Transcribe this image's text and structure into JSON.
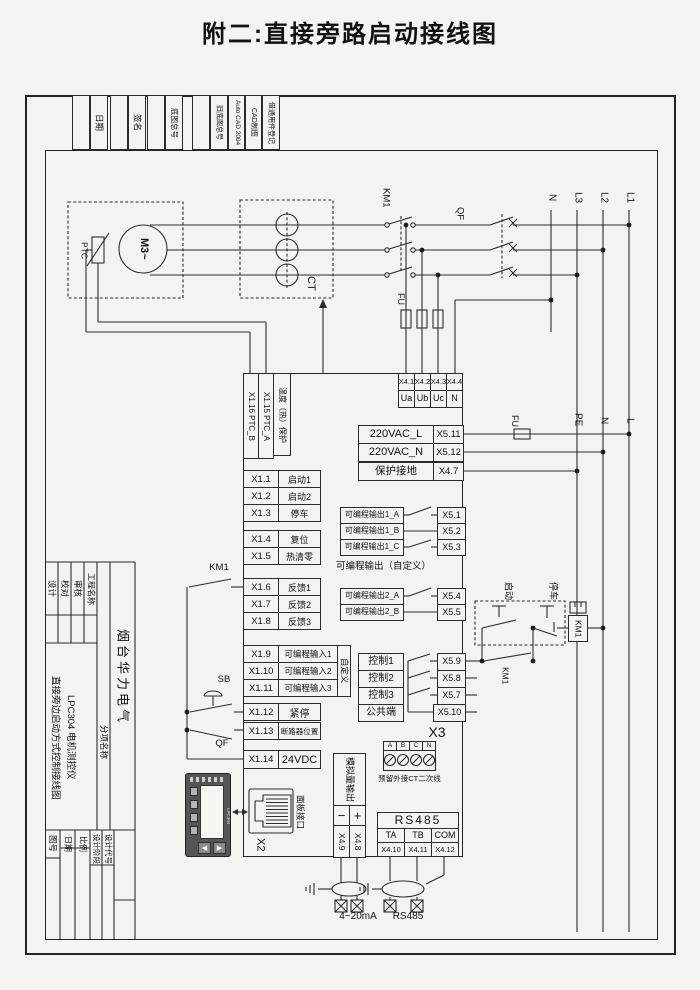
{
  "page_title": "附二:直接旁路启动接线图",
  "header_strip": {
    "date": "日期",
    "sign": "签名",
    "base_no": "底图总号",
    "old_base_no": "旧底图总号",
    "cad": "Auto CAD 2004",
    "cad2": "CAD制图",
    "borrow": "借通用件登记"
  },
  "title_block": {
    "design": "设计",
    "check": "校对",
    "review": "审核",
    "proj": "工程名称",
    "company": "烟台华力电气",
    "product": "LPC304 电机测控仪",
    "dtitle": "直接旁边启动方式控制接线图",
    "sub": "分项名称",
    "dno": "图号",
    "date": "日期",
    "scale": "比例",
    "stage": "设计阶段",
    "code": "设计代号"
  },
  "power": {
    "n_top": "N",
    "l3": "L3",
    "l2": "L2",
    "l1": "L1",
    "pe": "PE",
    "n_mid": "N",
    "l_mid": "L",
    "qf": "QF",
    "km1": "KM1",
    "fu_top": "FU",
    "fu_mid": "FU"
  },
  "motor": {
    "m": "M",
    "ph": "3~",
    "ptc": "PTC",
    "ct": "CT"
  },
  "left": {
    "km1": "KM1",
    "sb": "SB",
    "qf": "QF"
  },
  "start_box": {
    "start": "启动",
    "stop": "停车",
    "coil": "KM1",
    "hold": "KM1"
  },
  "device": {
    "ptc_b": "X1.16 PTC_B",
    "ptc_a": "X1.15 PTC_A",
    "temp": "温度（热）保护",
    "x4": {
      "i1": "X4.1",
      "i2": "X4.2",
      "i3": "X4.3",
      "i4": "X4.4",
      "u1": "Ua",
      "u2": "Ub",
      "u3": "Uc",
      "u4": "N"
    },
    "sup": [
      {
        "l": "220VAC_L",
        "i": "X5.11"
      },
      {
        "l": "220VAC_N",
        "i": "X5.12"
      },
      {
        "l": "保护接地",
        "i": "X4.7"
      }
    ],
    "x1": [
      {
        "i": "X1.1",
        "l": "启动1"
      },
      {
        "i": "X1.2",
        "l": "启动2"
      },
      {
        "i": "X1.3",
        "l": "停车"
      },
      {
        "i": "X1.4",
        "l": "复位"
      },
      {
        "i": "X1.5",
        "l": "热清零"
      },
      {
        "i": "X1.6",
        "l": "反馈1"
      },
      {
        "i": "X1.7",
        "l": "反馈2"
      },
      {
        "i": "X1.8",
        "l": "反馈3"
      },
      {
        "i": "X1.9",
        "l": "可编程输入1"
      },
      {
        "i": "X1.10",
        "l": "可编程输入2"
      },
      {
        "i": "X1.11",
        "l": "可编程输入3"
      },
      {
        "i": "X1.12",
        "l": "紧停"
      },
      {
        "i": "X1.13",
        "l": "断路器位置"
      },
      {
        "i": "X1.14",
        "l": "24VDC"
      }
    ],
    "custom": "自定义",
    "out1": [
      {
        "l": "可编程输出1_A",
        "i": "X5.1"
      },
      {
        "l": "可编程输出1_B",
        "i": "X5.2"
      },
      {
        "l": "可编程输出1_C",
        "i": "X5.3"
      }
    ],
    "outc": "可编程输出（自定义）",
    "out2": [
      {
        "l": "可编程输出2_A",
        "i": "X5.4"
      },
      {
        "l": "可编程输出2_B",
        "i": "X5.5"
      }
    ],
    "ctl": [
      {
        "l": "控制1",
        "i": "X5.9"
      },
      {
        "l": "控制2",
        "i": "X5.8"
      },
      {
        "l": "控制3",
        "i": "X5.7"
      },
      {
        "l": "公共端",
        "i": "X5.10"
      }
    ],
    "x3": "X3",
    "ct2": {
      "a": "A",
      "b": "B",
      "c": "C",
      "n": "N",
      "cap": "预留外接CT二次线"
    },
    "rs485": {
      "t": "RS485",
      "c1": "TA",
      "c2": "TB",
      "c3": "COM",
      "i1": "X4.10",
      "i2": "X4.11",
      "i3": "X4.12"
    },
    "ana": {
      "cap": "模拟量输出",
      "minus": "−",
      "plus": "+",
      "im": "X4.9",
      "ip": "X4.8"
    },
    "panel": {
      "port": "面板接口",
      "x2": "X2",
      "model": "LPC304",
      "arrow_left": "◀",
      "arrow_right": "▶"
    }
  },
  "cables": {
    "a": "4~20mA",
    "b": "RS485"
  }
}
